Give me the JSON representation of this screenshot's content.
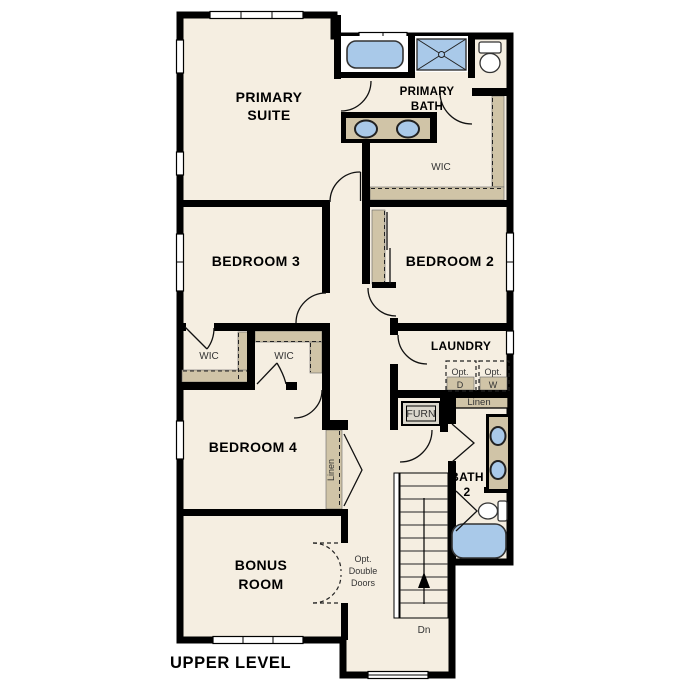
{
  "title": {
    "label": "UPPER LEVEL"
  },
  "colors": {
    "floor": "#f5eee1",
    "wall": "#000000",
    "casework": "#d0c4a7",
    "fixtures": "#a9c9e9",
    "window": "#ffffff",
    "text": "#000000",
    "small_text": "#333333"
  },
  "rooms": {
    "primary_suite": {
      "line1": "PRIMARY",
      "line2": "SUITE"
    },
    "primary_bath": {
      "line1": "PRIMARY",
      "line2": "BATH"
    },
    "wic_primary": {
      "label": "WIC"
    },
    "bedroom3": {
      "label": "BEDROOM 3"
    },
    "bedroom2": {
      "label": "BEDROOM 2"
    },
    "wic_left": {
      "label": "WIC"
    },
    "wic_right": {
      "label": "WIC"
    },
    "laundry": {
      "label": "LAUNDRY"
    },
    "bedroom4": {
      "label": "BEDROOM 4"
    },
    "bath2": {
      "line1": "BATH",
      "line2": "2"
    },
    "bonus_room": {
      "line1": "BONUS",
      "line2": "ROOM"
    }
  },
  "annotations": {
    "opt_dryer": {
      "line1": "Opt.",
      "line2": "D"
    },
    "opt_washer": {
      "line1": "Opt.",
      "line2": "W"
    },
    "furnace": {
      "label": "FURN"
    },
    "linen_hall": {
      "label": "Linen"
    },
    "linen_bedroom4": {
      "label": "Linen"
    },
    "opt_double_doors": {
      "line1": "Opt.",
      "line2": "Double",
      "line3": "Doors"
    },
    "stairs_down": {
      "label": "Dn"
    }
  }
}
